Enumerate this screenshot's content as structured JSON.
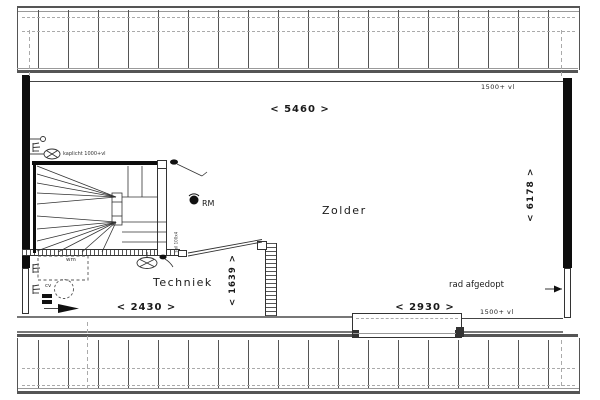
{
  "rooms": {
    "zolder": "Zolder",
    "techniek": "Techniek"
  },
  "dimensions": {
    "top_width": "< 5460 >",
    "right_height": "< 6178 >",
    "bottom_left_width": "< 2430 >",
    "bottom_right_width": "< 2930 >",
    "techniek_height": "< 1639 >"
  },
  "annotations": {
    "knee_wall_top": "1500+ vl",
    "knee_wall_bottom": "1500+ vl",
    "radiator_note": "rad afgedopt",
    "smoke_detector": "RM",
    "attic_light": "kaplicht 1000+vl",
    "washing_machine": "wm",
    "central_heating": "cv",
    "stair_note": "spil 100x4"
  },
  "colors": {
    "line": "#333333",
    "wall": "#0d0d0d",
    "hatch_gray": "#555555",
    "dash_gray": "#aaaaaa"
  }
}
